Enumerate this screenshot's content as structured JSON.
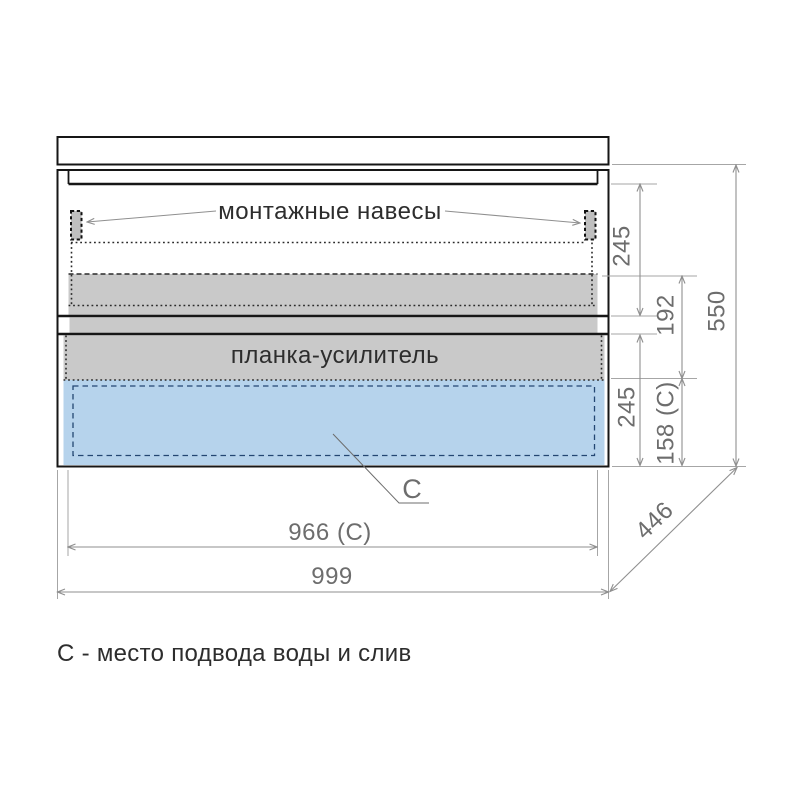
{
  "drawing": {
    "annotations": {
      "mounting_hangers": "монтажные навесы",
      "reinforcement_bar": "планка-усилитель",
      "zone_marker": "C"
    },
    "dimensions": {
      "top_section_height": "245",
      "hanger_zone_to_bar": "192",
      "total_height": "550",
      "bottom_section_height": "245",
      "service_zone_height": "158 (C)",
      "inner_width": "966 (C)",
      "total_width": "999",
      "depth": "446"
    },
    "caption": "С - место подвода воды и слив",
    "colors": {
      "panel_gray": "#c9c9c9",
      "hanger_gray": "#bfbfbf",
      "service_zone_blue": "#b6d3ec",
      "service_zone_border": "#234672",
      "outline": "#161616",
      "dimension": "#8f8f8f"
    }
  }
}
